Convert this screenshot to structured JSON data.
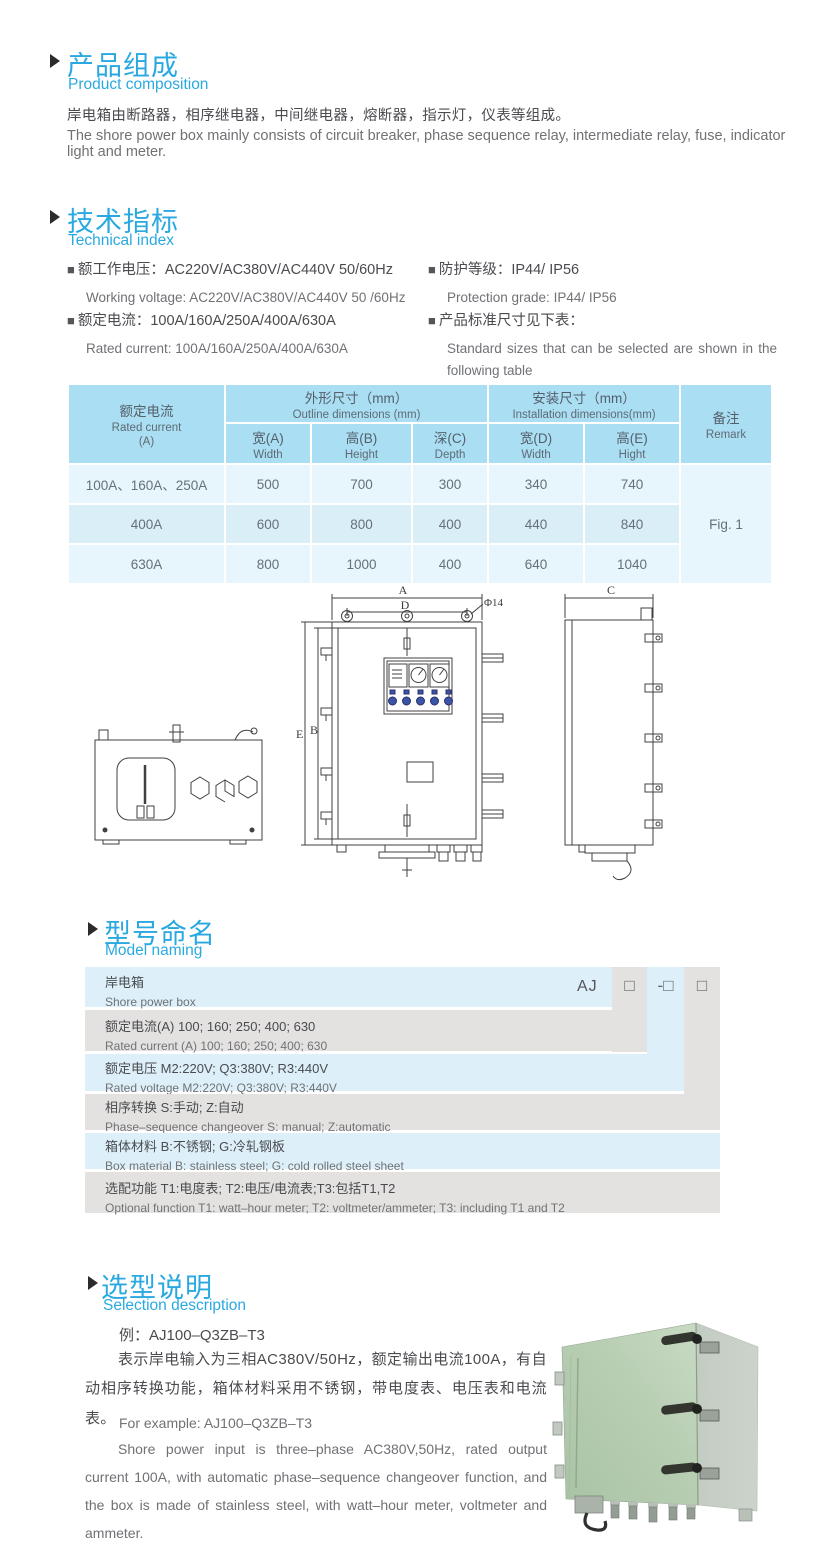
{
  "page": {
    "bg": "#ffffff",
    "accent": "#2aa9e1"
  },
  "sections": {
    "composition": {
      "title_cn": "产品组成",
      "title_en": "Product  composition",
      "body_cn": "岸电箱由断路器，相序继电器，中间继电器，熔断器，指示灯，仪表等组成。",
      "body_en": "The shore power box mainly consists of circuit breaker, phase sequence relay, intermediate relay, fuse, indicator light and meter."
    },
    "technical": {
      "title_cn": "技术指标",
      "title_en": "Technical index",
      "items": [
        {
          "cn": "额工作电压：AC220V/AC380V/AC440V  50/60Hz",
          "en": "Working voltage: AC220V/AC380V/AC440V 50 /60Hz"
        },
        {
          "cn": "额定电流：100A/160A/250A/400A/630A",
          "en": "Rated current: 100A/160A/250A/400A/630A"
        },
        {
          "cn": "防护等级：IP44/ IP56",
          "en": "Protection grade: IP44/ IP56"
        },
        {
          "cn": "产品标准尺寸见下表：",
          "en": "Standard sizes that can be selected are shown in the following table"
        }
      ],
      "bullet": "■"
    },
    "naming": {
      "title_cn": "型号命名",
      "title_en": "Model naming",
      "prefix": "AJ",
      "slot1": "□",
      "slot2": "-□",
      "slot3": "□",
      "rows": [
        {
          "cn": "岸电箱",
          "en": "Shore power box"
        },
        {
          "cn": "额定电流(A)  100; 160; 250; 400; 630",
          "en": "Rated current (A) 100; 160; 250; 400; 630"
        },
        {
          "cn": "额定电压   M2:220V;  Q3:380V;  R3:440V",
          "en": "Rated voltage   M2:220V;  Q3:380V;  R3:440V"
        },
        {
          "cn": "相序转换  S:手动; Z:自动",
          "en": "Phase–sequence changeover  S: manual;  Z:automatic"
        },
        {
          "cn": "箱体材料    B:不锈钢;  G:冷轧钢板",
          "en": "Box material    B: stainless steel; G: cold rolled steel sheet"
        },
        {
          "cn": "选配功能      T1:电度表;  T2:电压/电流表;T3:包括T1,T2",
          "en": "Optional function   T1: watt–hour meter; T2: voltmeter/ammeter; T3: including T1 and T2"
        }
      ]
    },
    "selection": {
      "title_cn": "选型说明",
      "title_en": "Selection description",
      "example_cn": "例：AJ100–Q3ZB–T3",
      "body_cn": "表示岸电输入为三相AC380V/50Hz，额定输出电流100A，有自动相序转换功能，箱体材料采用不锈钢，带电度表、电压表和电流表。",
      "example_en": "For example: AJ100–Q3ZB–T3",
      "body_en": "Shore power input is three–phase AC380V,50Hz, rated output current 100A, with automatic phase–sequence changeover function, and the box is made of stainless steel, with watt–hour meter, voltmeter and ammeter."
    }
  },
  "spec_table": {
    "headers": {
      "rated_current_cn": "额定电流",
      "rated_current_en": "Rated current",
      "rated_current_unit": "(A)",
      "outline_cn": "外形尺寸（mm）",
      "outline_en": "Outline dimensions (mm)",
      "install_cn": "安装尺寸（mm）",
      "install_en": "Installation dimensions(mm)",
      "remark_cn": "备注",
      "remark_en": "Remark",
      "sub": [
        {
          "cn": "宽(A)",
          "en": "Width"
        },
        {
          "cn": "高(B)",
          "en": "Height"
        },
        {
          "cn": "深(C)",
          "en": "Depth"
        },
        {
          "cn": "宽(D)",
          "en": "Width"
        },
        {
          "cn": "高(E)",
          "en": "Hight"
        }
      ]
    },
    "rows": [
      {
        "current": "100A、160A、250A",
        "w": "500",
        "h": "700",
        "d": "300",
        "iw": "340",
        "ih": "740"
      },
      {
        "current": "400A",
        "w": "600",
        "h": "800",
        "d": "400",
        "iw": "440",
        "ih": "840"
      },
      {
        "current": "630A",
        "w": "800",
        "h": "1000",
        "d": "400",
        "iw": "640",
        "ih": "1040"
      }
    ],
    "remark": "Fig. 1"
  },
  "drawing": {
    "labels": {
      "A": "A",
      "B": "B",
      "C": "C",
      "D": "D",
      "E": "E",
      "phi": "Φ14"
    }
  }
}
